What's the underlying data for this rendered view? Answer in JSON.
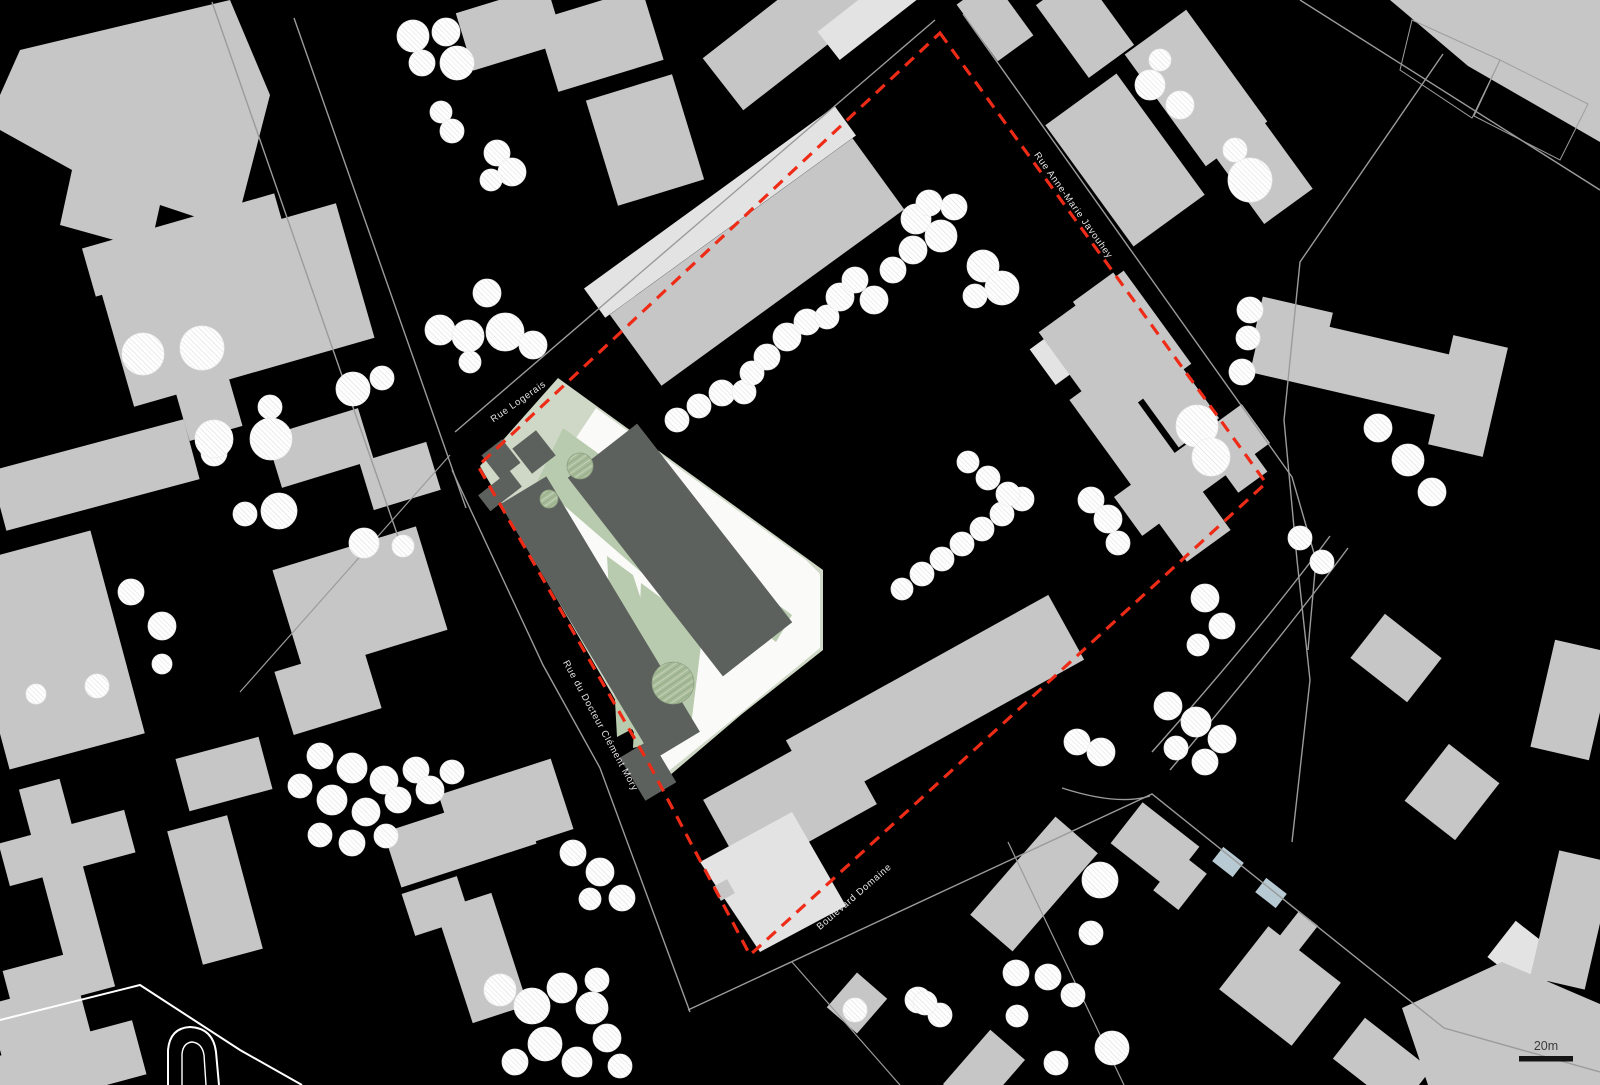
{
  "map": {
    "width": 1600,
    "height": 1085,
    "labels": {
      "rue_logerais": "Rue Logerais",
      "rue_anne_marie_javouhey": "Rue Anne-Marie Javouhey",
      "rue_du_docteur": "Rue du Docteur Clément Mory",
      "boulevard": "Boulevard Domaine"
    },
    "scale_bar": {
      "label": "20m"
    },
    "colors": {
      "bg": "#000000",
      "g": "#c6c6c6",
      "e": "#e3e3e3",
      "d": "#5d615e",
      "G": "#cfd8c7",
      "L": "#b9cbae",
      "P": "#fafaf8",
      "B": "#b7c9d2",
      "O": "#9e9e9e",
      "red": "#ee2b16",
      "line": "#9b9b9b",
      "whiteline": "#ffffff",
      "label": "#e6e6e6",
      "scaletext": "#3d3d3d",
      "treefill": "#ffffff",
      "treestroke": "#efefef",
      "greentree": "#a8bc9a",
      "scalebar": "#141414"
    },
    "boundary": "940,33 1266,483 750,955 648,762 478,466",
    "shapes": [
      {
        "p": "20,50 230,0 270,95 235,230 160,205 150,250 60,225 72,170 0,130 0,95",
        "c": "g"
      },
      {
        "p": "1390,0 1600,0 1600,142 1468,66",
        "c": "g"
      },
      {
        "r": [
          510,
          28,
          95,
          60,
          -17
        ],
        "c": "g"
      },
      {
        "r": [
          600,
          40,
          110,
          75,
          -17
        ],
        "c": "g"
      },
      {
        "r": [
          645,
          140,
          90,
          110,
          -17
        ],
        "c": "g"
      },
      {
        "r": [
          185,
          245,
          200,
          50,
          -16
        ],
        "c": "g"
      },
      {
        "r": [
          235,
          305,
          250,
          140,
          -16
        ],
        "c": "g"
      },
      {
        "r": [
          205,
          395,
          55,
          80,
          -16
        ],
        "c": "g"
      },
      {
        "r": [
          95,
          475,
          200,
          62,
          -15
        ],
        "c": "g"
      },
      {
        "r": [
          50,
          650,
          140,
          210,
          -15
        ],
        "c": "g"
      },
      {
        "r": [
          67,
          888,
          42,
          215,
          -15
        ],
        "c": "g"
      },
      {
        "r": [
          67,
          848,
          130,
          44,
          -15
        ],
        "c": "g"
      },
      {
        "r": [
          50,
          978,
          88,
          38,
          -15
        ],
        "c": "g"
      },
      {
        "r": [
          360,
          600,
          150,
          108,
          -17
        ],
        "c": "g"
      },
      {
        "r": [
          328,
          690,
          92,
          66,
          -17
        ],
        "c": "g"
      },
      {
        "r": [
          224,
          774,
          86,
          54,
          -15
        ],
        "c": "g"
      },
      {
        "r": [
          215,
          890,
          62,
          138,
          -15
        ],
        "c": "g"
      },
      {
        "r": [
          45,
          1040,
          92,
          98,
          -15
        ],
        "c": "g"
      },
      {
        "r": [
          62,
          1068,
          160,
          56,
          -15
        ],
        "c": "g"
      },
      {
        "r": [
          320,
          448,
          96,
          54,
          -17
        ],
        "c": "g"
      },
      {
        "r": [
          400,
          476,
          70,
          50,
          -17
        ],
        "c": "g"
      },
      {
        "r": [
          460,
          838,
          142,
          58,
          -18
        ],
        "c": "g"
      },
      {
        "r": [
          506,
          812,
          118,
          74,
          -18
        ],
        "c": "g"
      },
      {
        "r": [
          482,
          958,
          58,
          118,
          -18
        ],
        "c": "g"
      },
      {
        "r": [
          436,
          906,
          58,
          44,
          -18
        ],
        "c": "g"
      },
      {
        "r": [
          790,
          32,
          170,
          66,
          -38
        ],
        "c": "g"
      },
      {
        "r": [
          872,
          12,
          110,
          36,
          -38
        ],
        "c": "e"
      },
      {
        "r": [
          995,
          20,
          70,
          44,
          54
        ],
        "c": "g"
      },
      {
        "r": [
          1085,
          25,
          90,
          56,
          54
        ],
        "c": "g"
      },
      {
        "r": [
          1196,
          88,
          138,
          76,
          54
        ],
        "c": "g"
      },
      {
        "r": [
          1262,
          170,
          90,
          60,
          54
        ],
        "c": "g"
      },
      {
        "r": [
          1125,
          160,
          150,
          88,
          54
        ],
        "c": "g"
      },
      {
        "r": [
          1370,
          368,
          232,
          62,
          13
        ],
        "c": "g"
      },
      {
        "r": [
          1468,
          396,
          56,
          112,
          13
        ],
        "c": "g"
      },
      {
        "r": [
          1292,
          330,
          72,
          52,
          13
        ],
        "c": "g"
      },
      {
        "r": [
          1396,
          658,
          72,
          56,
          38
        ],
        "c": "g"
      },
      {
        "r": [
          1572,
          700,
          60,
          110,
          13
        ],
        "c": "g"
      },
      {
        "r": [
          1452,
          792,
          64,
          72,
          38
        ],
        "c": "g"
      },
      {
        "r": [
          1155,
          845,
          72,
          52,
          38
        ],
        "c": "g"
      },
      {
        "r": [
          1180,
          882,
          32,
          46,
          38
        ],
        "c": "g"
      },
      {
        "r": [
          1228,
          862,
          26,
          18,
          38
        ],
        "c": "B"
      },
      {
        "r": [
          1271,
          893,
          26,
          18,
          38
        ],
        "c": "B"
      },
      {
        "r": [
          1034,
          884,
          130,
          56,
          -49
        ],
        "c": "g"
      },
      {
        "r": [
          857,
          1003,
          46,
          40,
          -49
        ],
        "c": "g"
      },
      {
        "r": [
          984,
          1072,
          72,
          46,
          -49
        ],
        "c": "g"
      },
      {
        "r": [
          1287,
          946,
          24,
          70,
          38
        ],
        "c": "g"
      },
      {
        "r": [
          1280,
          986,
          92,
          80,
          38
        ],
        "c": "g"
      },
      {
        "r": [
          1382,
          1064,
          84,
          52,
          38
        ],
        "c": "g"
      },
      {
        "r": [
          1526,
          958,
          62,
          46,
          38
        ],
        "c": "e"
      },
      {
        "r": [
          1572,
          920,
          56,
          130,
          13
        ],
        "c": "g"
      },
      {
        "p": "1402,1008 1502,962 1600,1004 1600,1085 1428,1085",
        "c": "g"
      },
      {
        "r": [
          720,
          212,
          310,
          36,
          -36
        ],
        "c": "e"
      },
      {
        "r": [
          757,
          262,
          300,
          88,
          -36
        ],
        "c": "g"
      },
      {
        "r": [
          1058,
          356,
          44,
          38,
          54
        ],
        "c": "e"
      },
      {
        "r": [
          1146,
          360,
          180,
          50,
          54
        ],
        "c": "g"
      },
      {
        "r": [
          1115,
          348,
          115,
          105,
          54
        ],
        "c": "g"
      },
      {
        "r": [
          1150,
          465,
          200,
          54,
          54
        ],
        "c": "g"
      },
      {
        "r": [
          1192,
          470,
          158,
          48,
          -36
        ],
        "c": "g"
      },
      {
        "r": [
          1244,
          470,
          36,
          30,
          -36
        ],
        "c": "g"
      },
      {
        "r": [
          935,
          700,
          300,
          74,
          -29
        ],
        "c": "g"
      },
      {
        "r": [
          790,
          802,
          150,
          88,
          -29
        ],
        "c": "g"
      },
      {
        "p": "700,862 792,812 846,906 760,952",
        "c": "e"
      },
      {
        "r": [
          724,
          890,
          16,
          16,
          -29
        ],
        "c": "g"
      },
      {
        "p": "1412,20 1500,60 1472,118 1400,70",
        "c": "O"
      },
      {
        "p": "1500,60 1588,104 1560,160 1474,116",
        "c": "O"
      },
      {
        "p": "558,378 750,517 823,570 823,650 742,714 662,782 643,748 480,466",
        "c": "G"
      },
      {
        "p": "596,408 806,560 820,574 820,648 742,712 660,778 646,750 566,520 556,468",
        "c": "P"
      },
      {
        "p": "563,428 700,527 656,585 537,482",
        "c": "L"
      },
      {
        "p": "607,556 633,575 676,706 617,737",
        "c": "L"
      },
      {
        "p": "641,583 703,629 690,734 633,748",
        "c": "L"
      },
      {
        "p": "700,548 792,615 776,642 686,572",
        "c": "L"
      },
      {
        "r": [
          680,
          550,
          252,
          88,
          52
        ],
        "c": "d"
      },
      {
        "r": [
          600,
          618,
          298,
          54,
          59
        ],
        "c": "d"
      },
      {
        "r": [
          648,
          770,
          50,
          36,
          59
        ],
        "c": "d"
      },
      {
        "r": [
          501,
          459,
          30,
          26,
          52
        ],
        "c": "d"
      },
      {
        "r": [
          534,
          452,
          32,
          30,
          52
        ],
        "c": "d"
      },
      {
        "r": [
          500,
          491,
          20,
          40,
          52
        ],
        "c": "d"
      }
    ],
    "roads": [
      {
        "d": "M294,18 L466,508",
        "c": "line",
        "w": 1.4
      },
      {
        "d": "M212,2 L402,548",
        "c": "line",
        "w": 1.4
      },
      {
        "d": "M455,432 L935,20",
        "c": "line",
        "w": 1.4
      },
      {
        "d": "M452,470 L543,665 L600,768 L690,1012",
        "c": "line",
        "w": 1.4
      },
      {
        "d": "M688,1010 L1152,794 L1444,1028 L1600,1072",
        "c": "line",
        "w": 1.4
      },
      {
        "d": "M963,14 L1292,477 L1316,560 L1308,650",
        "c": "line",
        "w": 1.4
      },
      {
        "d": "M1443,54 L1300,262 L1284,420 L1297,560 L1310,680 L1292,842",
        "c": "line",
        "w": 1.4
      },
      {
        "d": "M1170,770 Q1280,640 1348,548",
        "c": "line",
        "w": 1.4
      },
      {
        "d": "M1152,752 Q1262,628 1330,536",
        "c": "line",
        "w": 1.4
      },
      {
        "d": "M450,455 L240,692",
        "c": "line",
        "w": 1.2
      },
      {
        "d": "M1300,0 L1600,190",
        "c": "line",
        "w": 1.4
      },
      {
        "d": "M792,962 L900,1085",
        "c": "line",
        "w": 1.2
      },
      {
        "d": "M1008,842 L1124,1085",
        "c": "line",
        "w": 1.2
      },
      {
        "d": "M1062,788 Q1118,806 1150,796",
        "c": "line",
        "w": 1.4
      },
      {
        "d": "M0,1020 L140,985 L240,1050 L302,1085",
        "c": "whiteline",
        "w": 2
      },
      {
        "d": "M168,1085 L168,1050 Q170,1028 190,1027 Q213,1028 216,1052 L219,1085",
        "c": "whiteline",
        "w": 2
      },
      {
        "d": "M182,1085 L182,1054 Q183,1043 192,1042 Q202,1043 204,1055 L206,1085",
        "c": "whiteline",
        "w": 1.4
      }
    ],
    "trees_white": [
      [
        413,
        36,
        16
      ],
      [
        446,
        32,
        14
      ],
      [
        457,
        63,
        17
      ],
      [
        422,
        63,
        13
      ],
      [
        441,
        112,
        11
      ],
      [
        452,
        131,
        12
      ],
      [
        497,
        153,
        13
      ],
      [
        512,
        172,
        14
      ],
      [
        491,
        180,
        11
      ],
      [
        487,
        293,
        14
      ],
      [
        440,
        330,
        15
      ],
      [
        468,
        336,
        16
      ],
      [
        505,
        332,
        19
      ],
      [
        533,
        345,
        14
      ],
      [
        470,
        362,
        11
      ],
      [
        353,
        389,
        17
      ],
      [
        382,
        378,
        12
      ],
      [
        270,
        407,
        12
      ],
      [
        277,
        446,
        12
      ],
      [
        214,
        453,
        13
      ],
      [
        245,
        514,
        12
      ],
      [
        143,
        354,
        21
      ],
      [
        202,
        348,
        22
      ],
      [
        214,
        439,
        19
      ],
      [
        271,
        439,
        21
      ],
      [
        279,
        511,
        18
      ],
      [
        364,
        543,
        15
      ],
      [
        403,
        546,
        11
      ],
      [
        131,
        592,
        13
      ],
      [
        162,
        626,
        14
      ],
      [
        36,
        694,
        10
      ],
      [
        97,
        686,
        12
      ],
      [
        162,
        664,
        10
      ],
      [
        320,
        756,
        13
      ],
      [
        352,
        768,
        15
      ],
      [
        384,
        780,
        14
      ],
      [
        416,
        770,
        13
      ],
      [
        300,
        786,
        12
      ],
      [
        332,
        800,
        15
      ],
      [
        366,
        812,
        14
      ],
      [
        398,
        800,
        13
      ],
      [
        320,
        835,
        12
      ],
      [
        352,
        843,
        13
      ],
      [
        386,
        836,
        12
      ],
      [
        430,
        790,
        14
      ],
      [
        452,
        772,
        12
      ],
      [
        573,
        853,
        13
      ],
      [
        600,
        872,
        14
      ],
      [
        622,
        898,
        13
      ],
      [
        590,
        899,
        11
      ],
      [
        500,
        990,
        16
      ],
      [
        532,
        1006,
        18
      ],
      [
        562,
        988,
        15
      ],
      [
        592,
        1008,
        16
      ],
      [
        545,
        1044,
        17
      ],
      [
        577,
        1062,
        15
      ],
      [
        607,
        1038,
        14
      ],
      [
        515,
        1062,
        13
      ],
      [
        597,
        980,
        12
      ],
      [
        620,
        1066,
        12
      ],
      [
        677,
        420,
        12
      ],
      [
        699,
        406,
        12
      ],
      [
        722,
        393,
        13
      ],
      [
        744,
        392,
        12
      ],
      [
        752,
        373,
        12
      ],
      [
        767,
        357,
        13
      ],
      [
        787,
        337,
        14
      ],
      [
        807,
        322,
        13
      ],
      [
        827,
        317,
        12
      ],
      [
        840,
        297,
        14
      ],
      [
        855,
        280,
        13
      ],
      [
        874,
        300,
        14
      ],
      [
        893,
        270,
        13
      ],
      [
        913,
        250,
        14
      ],
      [
        916,
        219,
        15
      ],
      [
        929,
        203,
        13
      ],
      [
        941,
        236,
        16
      ],
      [
        954,
        207,
        13
      ],
      [
        983,
        266,
        16
      ],
      [
        1002,
        288,
        17
      ],
      [
        975,
        296,
        12
      ],
      [
        902,
        589,
        11
      ],
      [
        922,
        574,
        12
      ],
      [
        942,
        559,
        12
      ],
      [
        962,
        544,
        12
      ],
      [
        982,
        529,
        12
      ],
      [
        1002,
        514,
        12
      ],
      [
        1022,
        499,
        12
      ],
      [
        968,
        462,
        11
      ],
      [
        988,
        478,
        12
      ],
      [
        1008,
        494,
        12
      ],
      [
        1197,
        426,
        21
      ],
      [
        1211,
        457,
        19
      ],
      [
        1091,
        500,
        13
      ],
      [
        1108,
        519,
        14
      ],
      [
        1118,
        543,
        12
      ],
      [
        1150,
        85,
        15
      ],
      [
        1180,
        105,
        14
      ],
      [
        1160,
        60,
        11
      ],
      [
        1250,
        180,
        22
      ],
      [
        1235,
        150,
        12
      ],
      [
        1250,
        310,
        13
      ],
      [
        1248,
        338,
        12
      ],
      [
        1242,
        372,
        13
      ],
      [
        1378,
        428,
        14
      ],
      [
        1408,
        460,
        16
      ],
      [
        1432,
        492,
        14
      ],
      [
        1300,
        538,
        12
      ],
      [
        1322,
        562,
        12
      ],
      [
        1205,
        598,
        14
      ],
      [
        1222,
        626,
        13
      ],
      [
        1198,
        645,
        11
      ],
      [
        1168,
        706,
        14
      ],
      [
        1196,
        722,
        15
      ],
      [
        1222,
        739,
        14
      ],
      [
        1176,
        748,
        12
      ],
      [
        1205,
        762,
        13
      ],
      [
        1077,
        742,
        13
      ],
      [
        1101,
        752,
        14
      ],
      [
        1100,
        880,
        18
      ],
      [
        1091,
        933,
        12
      ],
      [
        918,
        1000,
        13
      ],
      [
        940,
        1015,
        12
      ],
      [
        1016,
        973,
        13
      ],
      [
        1048,
        977,
        13
      ],
      [
        1073,
        995,
        12
      ],
      [
        1017,
        1016,
        11
      ],
      [
        1112,
        1048,
        17
      ],
      [
        1056,
        1063,
        12
      ],
      [
        855,
        1010,
        12
      ],
      [
        925,
        1003,
        12
      ]
    ],
    "trees_green": [
      [
        580,
        466,
        13
      ],
      [
        549,
        499,
        9
      ],
      [
        673,
        683,
        21
      ]
    ]
  }
}
